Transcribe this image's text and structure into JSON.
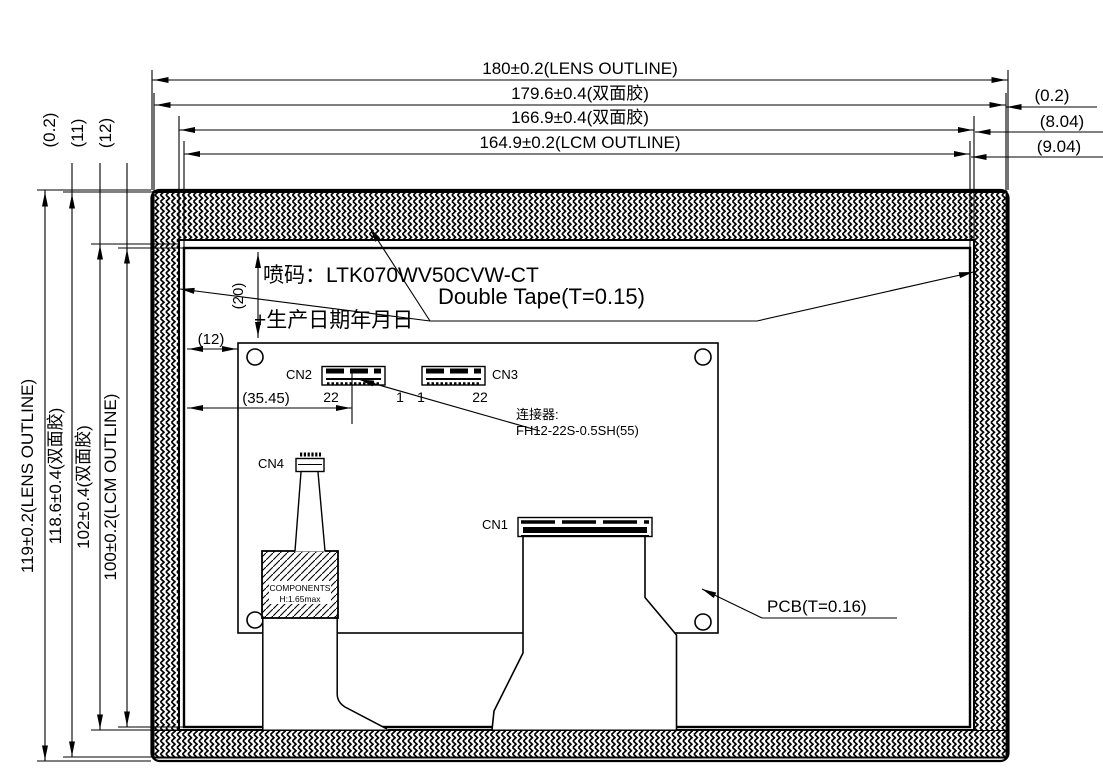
{
  "drawing": {
    "dims_top": [
      "180±0.2(LENS OUTLINE)",
      "179.6±0.4(双面胶)",
      "166.9±0.4(双面胶)",
      "164.9±0.2(LCM OUTLINE)"
    ],
    "dims_right": [
      "(0.2)",
      "(8.04)",
      "(9.04)"
    ],
    "dims_left": [
      "119±0.2(LENS OUTLINE)",
      "118.6±0.4(双面胶)",
      "102±0.4(双面胶)",
      "100±0.2(LCM OUTLINE)"
    ],
    "dims_left_top": [
      "(0.2)",
      "(11)",
      "(12)"
    ],
    "dims_inner": {
      "tape_top_offset": "(20)",
      "pcb_left_offset": "(12)",
      "cn2_offset": "(35.45)"
    },
    "labels": {
      "marking_line1": "喷码：LTK070WV50CVW-CT",
      "marking_line2": "+生产日期年月日",
      "double_tape": "Double Tape(T=0.15)",
      "pcb": "PCB(T=0.16)",
      "connector_note1": "连接器:",
      "connector_note2": "FH12-22S-0.5SH(55)",
      "components1": "COMPONENTS",
      "components2": "H:1.65max"
    },
    "connectors": {
      "cn1": {
        "name": "CN1"
      },
      "cn2": {
        "name": "CN2",
        "pin_left": "22",
        "pin_right": "1"
      },
      "cn3": {
        "name": "CN3",
        "pin_left": "1",
        "pin_right": "22"
      },
      "cn4": {
        "name": "CN4"
      }
    },
    "colors": {
      "line": "#000000",
      "background": "#ffffff"
    }
  }
}
